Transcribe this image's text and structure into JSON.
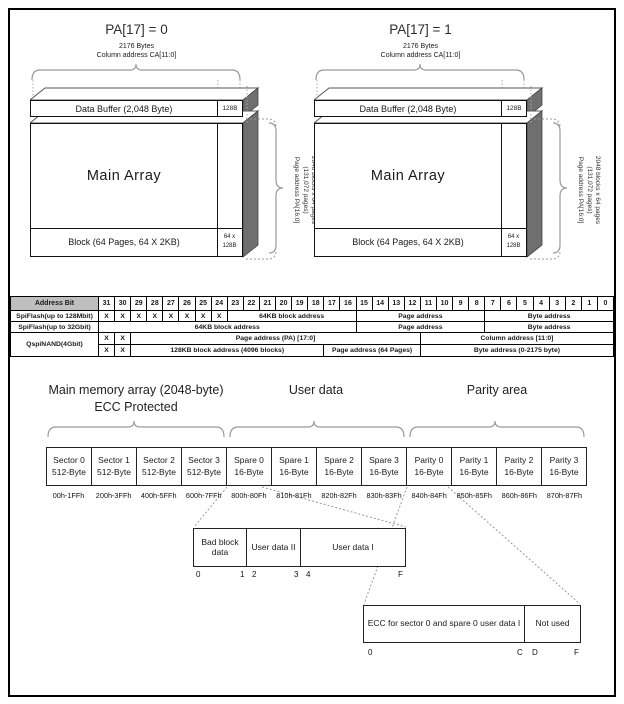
{
  "colors": {
    "side_fill": "#6f6f6f",
    "table_header_bg": "#bfbfbf"
  },
  "diagrams": [
    {
      "title": "PA[17] = 0",
      "bytes_label": "2176 Bytes",
      "column_label": "Column address CA[11:0]",
      "buffer_label": "Data Buffer (2,048 Byte)",
      "buffer_unit": "128B",
      "main_label": "Main Array",
      "block_label": "Block (64 Pages, 64 X 2KB)",
      "block_unit_line1": "64 x",
      "block_unit_line2": "128B",
      "side_line1": "2048 blocks x 64 pages",
      "side_line2": "(131,072 pages)",
      "side_line3": "Page address PA[16:0]"
    },
    {
      "title": "PA[17] = 1",
      "bytes_label": "2176 Bytes",
      "column_label": "Column address CA[11:0]",
      "buffer_label": "Data Buffer (2,048 Byte)",
      "buffer_unit": "128B",
      "main_label": "Main Array",
      "block_label": "Block (64 Pages, 64 X 2KB)",
      "block_unit_line1": "64 x",
      "block_unit_line2": "128B",
      "side_line1": "2048 blocks x 64 pages",
      "side_line2": "(131,072 pages)",
      "side_line3": "Page address PA[16:0]"
    }
  ],
  "table": {
    "header": "Address Bit",
    "bits": [
      "31",
      "30",
      "29",
      "28",
      "27",
      "26",
      "25",
      "24",
      "23",
      "22",
      "21",
      "20",
      "19",
      "18",
      "17",
      "16",
      "15",
      "14",
      "13",
      "12",
      "11",
      "10",
      "9",
      "8",
      "7",
      "6",
      "5",
      "4",
      "3",
      "2",
      "1",
      "0"
    ],
    "x_mark": "X",
    "rows": {
      "spiflash128": {
        "label": "SpiFlash(up to 128Mbit)",
        "block": "64KB block address",
        "page": "Page address",
        "byte": "Byte address"
      },
      "spiflash32": {
        "label": "SpiFlash(up to 32Gbit)",
        "block": "64KB block address",
        "page": "Page address",
        "byte": "Byte address"
      },
      "qspinand": {
        "label": "QspiNAND(4Gbit)",
        "page_pa": "Page address (PA) [17:0]",
        "column": "Column address [11:0]",
        "block128": "128KB block address (4096 blocks)",
        "page64": "Page address (64 Pages)",
        "byte2175": "Byte address (0-2175 byte)"
      }
    }
  },
  "memory_map": {
    "group_main_line1": "Main memory array (2048-byte)",
    "group_main_line2": "ECC Protected",
    "group_user": "User data",
    "group_parity": "Parity area",
    "cells": [
      {
        "name": "Sector 0",
        "size": "512-Byte",
        "range": "00h-1FFh"
      },
      {
        "name": "Sector 1",
        "size": "512-Byte",
        "range": "200h-3FFh"
      },
      {
        "name": "Sector 2",
        "size": "512-Byte",
        "range": "400h-5FFh"
      },
      {
        "name": "Sector 3",
        "size": "512-Byte",
        "range": "600h-7FFh"
      },
      {
        "name": "Spare 0",
        "size": "16-Byte",
        "range": "800h-80Fh"
      },
      {
        "name": "Spare 1",
        "size": "16-Byte",
        "range": "810h-81Fh"
      },
      {
        "name": "Spare 2",
        "size": "16-Byte",
        "range": "820h-82Fh"
      },
      {
        "name": "Spare 3",
        "size": "16-Byte",
        "range": "830h-83Fh"
      },
      {
        "name": "Parity 0",
        "size": "16-Byte",
        "range": "840h-84Fh"
      },
      {
        "name": "Parity 1",
        "size": "16-Byte",
        "range": "850h-85Fh"
      },
      {
        "name": "Parity 2",
        "size": "16-Byte",
        "range": "860h-86Fh"
      },
      {
        "name": "Parity 3",
        "size": "16-Byte",
        "range": "870h-87Fh"
      }
    ],
    "spare_detail": {
      "cell1": "Bad block data",
      "cell2": "User data II",
      "cell3": "User data I",
      "ticks": [
        "0",
        "1",
        "2",
        "3",
        "4",
        "F"
      ]
    },
    "parity_detail": {
      "cell1": "ECC for sector 0 and spare 0 user data I",
      "cell2": "Not used",
      "ticks": [
        "0",
        "C",
        "D",
        "F"
      ]
    }
  }
}
